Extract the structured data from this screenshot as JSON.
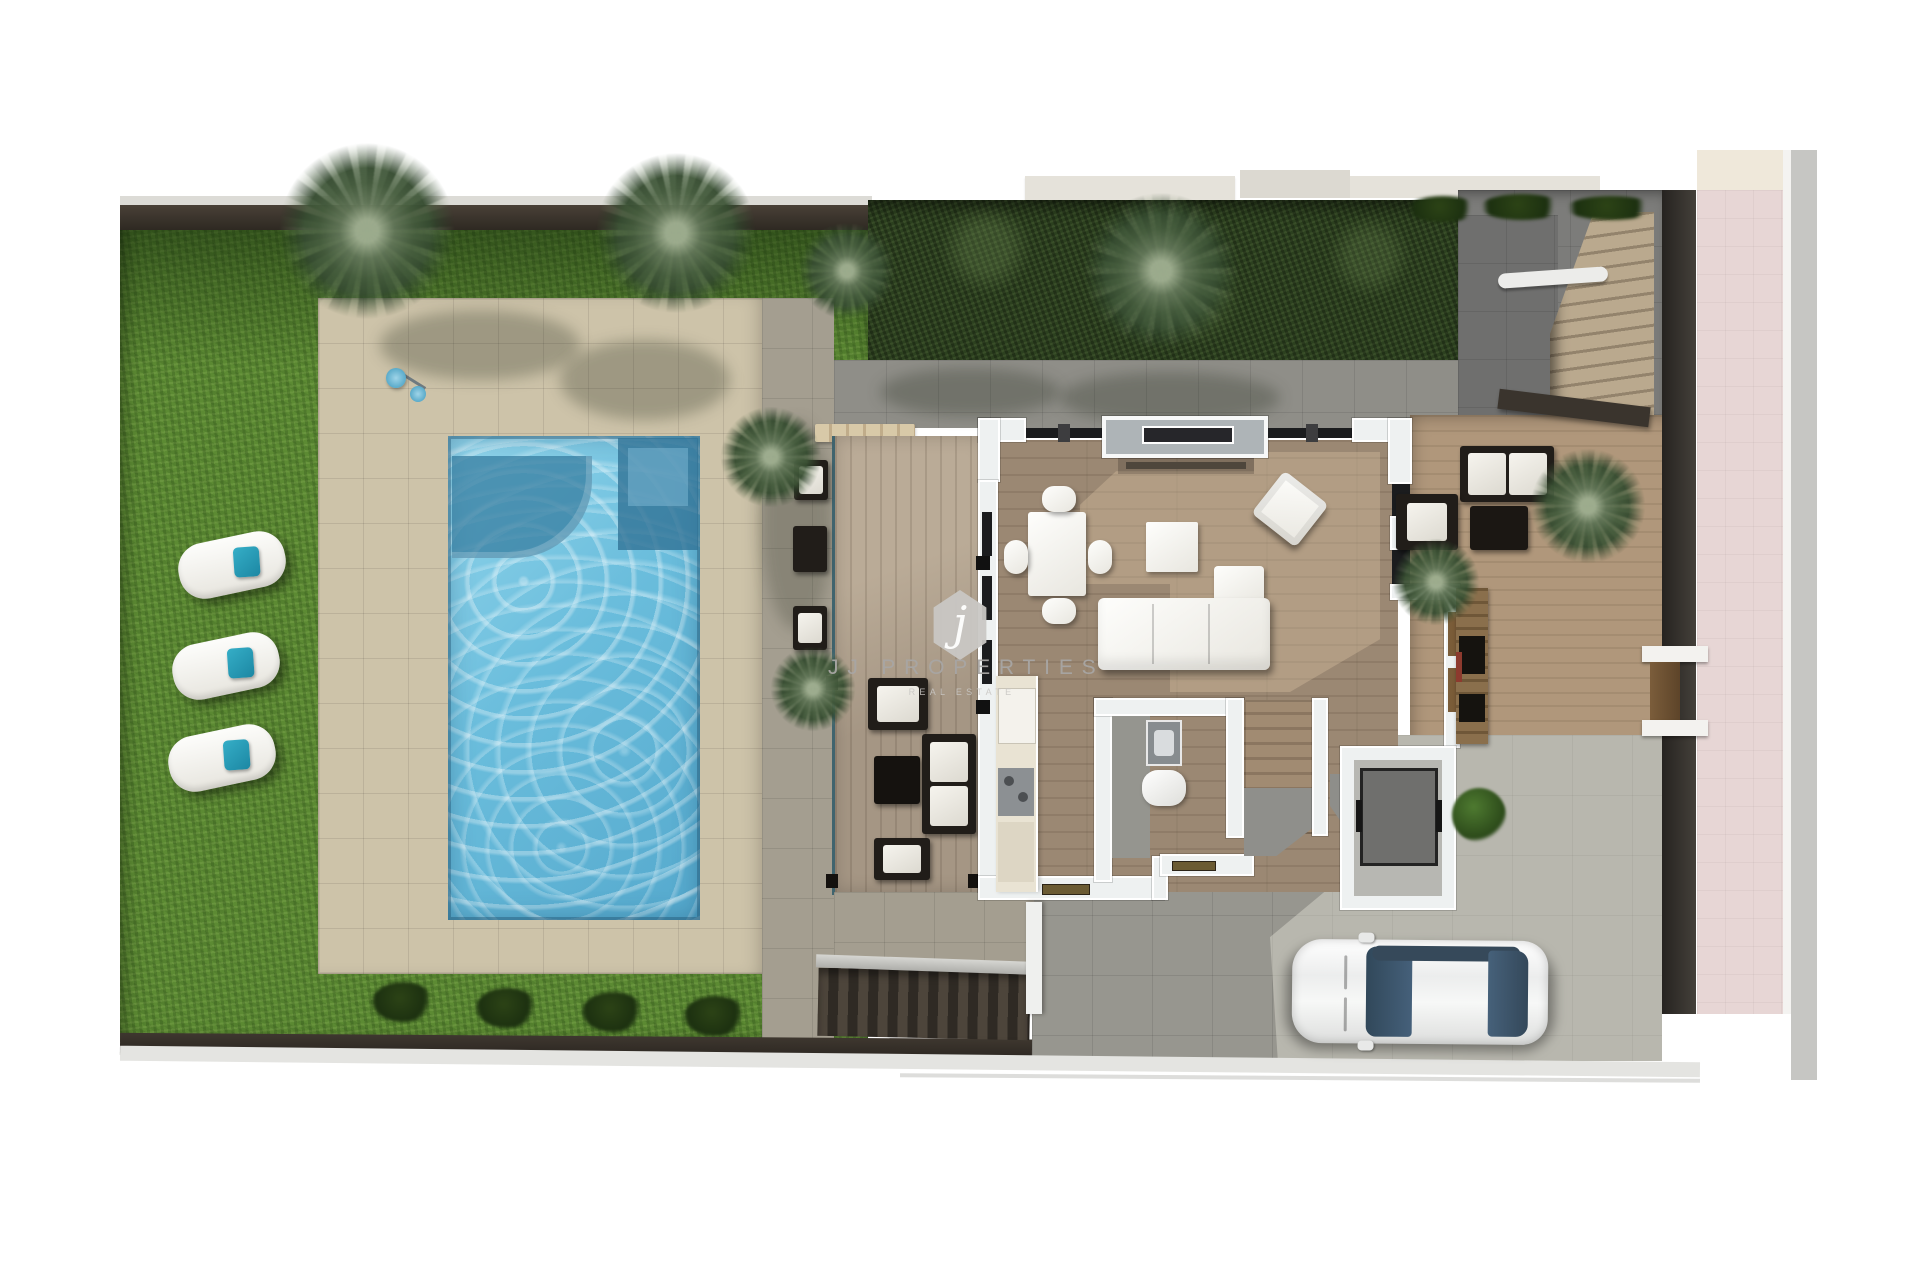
{
  "watermark": {
    "monogram": "j",
    "brand": "JJ PROPERTIES",
    "tagline": "REAL ESTATE"
  },
  "palette": {
    "lawn": "#5c8a33",
    "pool_water": "#69bcdc",
    "pool_deck": "#cdc3a9",
    "porch_wood": "#a59684",
    "interior_wood": "#9b8873",
    "terrace_wood": "#b0977b",
    "paving_gray": "#9b9a94",
    "terrace_dark_gray": "#7c7c7a",
    "hedge_green": "#2c401f",
    "fence_brown": "#39332c",
    "sidewalk_pink": "#e7d6d5",
    "wall_white": "#eef1f1",
    "accent_teal": "#2a9bb5",
    "car_glass": "#3c566b"
  },
  "scene": {
    "view": "top-down 3d floor plan render of a villa plot",
    "areas": [
      "garden-lawn",
      "swimming-pool",
      "pool-deck",
      "covered-porch",
      "living-dining-room",
      "kitchen",
      "bathroom",
      "interior-staircase",
      "utility-room",
      "east-terrace",
      "driveway",
      "exterior-staircase-north",
      "exterior-staircase-south",
      "street-sidewalk",
      "perimeter-hedge",
      "boundary-wall"
    ],
    "objects": [
      "sun-lounger x3",
      "palm-tree x8",
      "garden-bush x5",
      "outdoor-shower",
      "dining-table",
      "dining-chair x4",
      "l-shaped-sofa",
      "coffee-table",
      "armchair",
      "tv-media-wall",
      "kitchen-counter",
      "bathroom-sink",
      "toilet",
      "outdoor-sofa",
      "outdoor-armchair",
      "outdoor-coffee-table",
      "porch-lounge-set",
      "white-car",
      "side-gate"
    ]
  }
}
